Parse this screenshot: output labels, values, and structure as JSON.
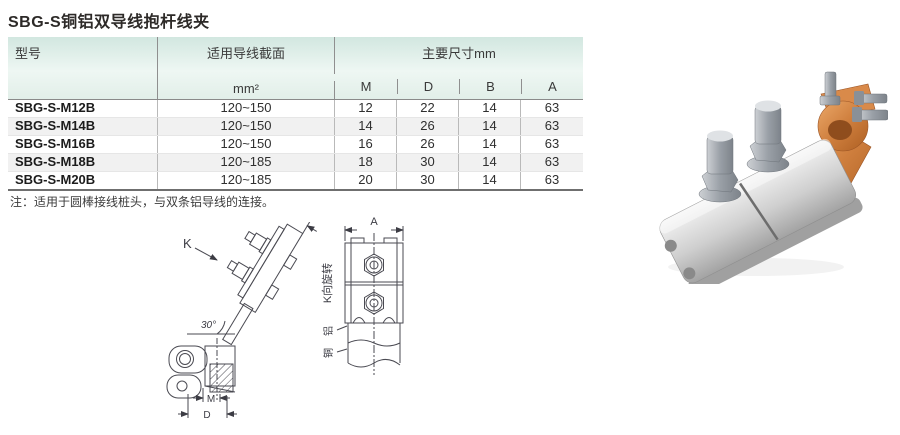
{
  "page": {
    "title": "SBG-S铜铝双导线抱杆线夹",
    "note": "注：适用于圆棒接线桩头，与双条铝导线的连接。"
  },
  "table": {
    "header": {
      "model": "型号",
      "section": "适用导线截面",
      "section_unit": "mm²",
      "dims_group": "主要尺寸mm",
      "dims": [
        "M",
        "D",
        "B",
        "A"
      ]
    },
    "rows": [
      {
        "model": "SBG-S-M12B",
        "section": "120~150",
        "m": "12",
        "d": "22",
        "b": "14",
        "a": "63"
      },
      {
        "model": "SBG-S-M14B",
        "section": "120~150",
        "m": "14",
        "d": "26",
        "b": "14",
        "a": "63"
      },
      {
        "model": "SBG-S-M16B",
        "section": "120~150",
        "m": "16",
        "d": "26",
        "b": "14",
        "a": "63"
      },
      {
        "model": "SBG-S-M18B",
        "section": "120~185",
        "m": "18",
        "d": "30",
        "b": "14",
        "a": "63"
      },
      {
        "model": "SBG-S-M20B",
        "section": "120~185",
        "m": "20",
        "d": "30",
        "b": "14",
        "a": "63"
      }
    ]
  },
  "drawing": {
    "labels": {
      "k_view": "K",
      "b_dim": "B",
      "angle": "30°",
      "m_dim": "M",
      "d_dim": "D",
      "a_dim": "A",
      "k_rotation": "K向旋转",
      "aluminum": "铝",
      "copper": "铜"
    }
  },
  "colors": {
    "header_green": "#d2e7e0",
    "row_stripe": "#f1f1f1",
    "line_art": "#4a4a52",
    "copper": "#cf7f3e",
    "aluminum": "#c9c9c9",
    "steel": "#9aa0a7"
  }
}
